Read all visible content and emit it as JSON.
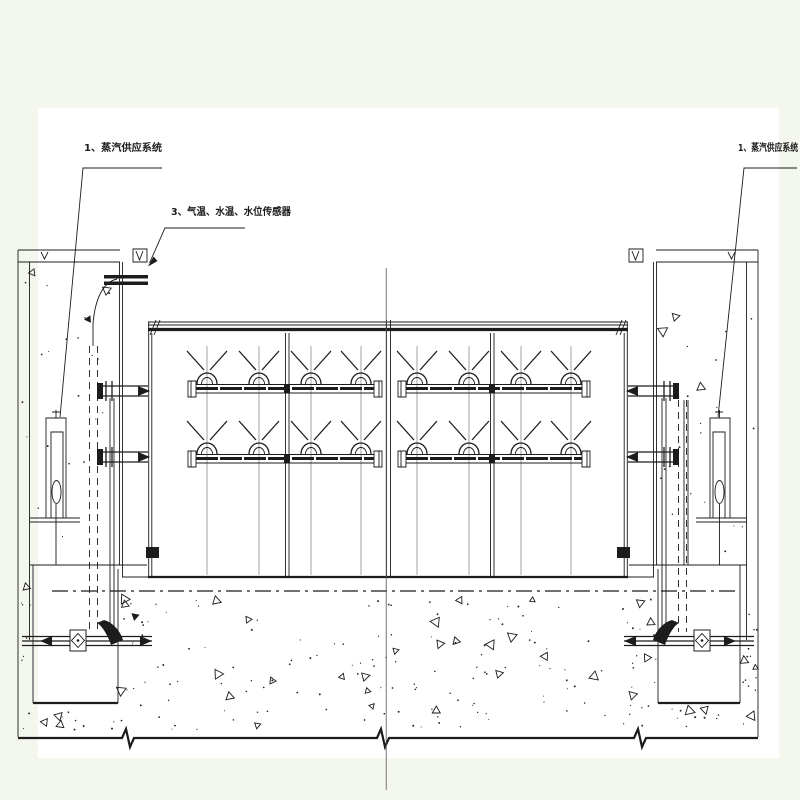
{
  "drawing": {
    "type": "engineering-section-drawing",
    "colors": {
      "background": "#f4f7ee",
      "sheet": "#ffffff",
      "ink": "#1c1c1c",
      "thin_line": "#666666"
    },
    "callouts": {
      "left_steam_system": "1、蒸汽供应系统",
      "sensors": "3、气温、水温、水位传感器",
      "right_steam_system": "1、蒸汽供应系统"
    }
  }
}
